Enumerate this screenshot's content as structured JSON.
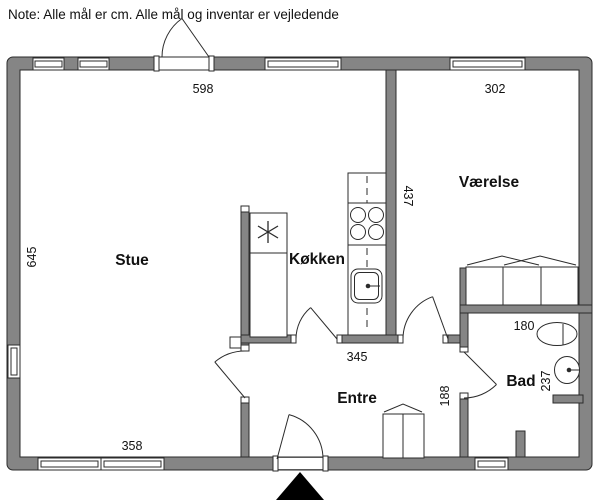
{
  "note": "Note: Alle mål er cm. Alle mål og inventar er vejledende",
  "rooms": {
    "stue": "Stue",
    "kokken": "Køkken",
    "vaerelse": "Værelse",
    "entre": "Entre",
    "bad": "Bad"
  },
  "dimensions": {
    "stue_top_width": "598",
    "vaerelse_top_width": "302",
    "left_height": "645",
    "vaerelse_height": "437",
    "kitchen_bottom": "345",
    "stue_bottom_window": "358",
    "bad_width": "180",
    "bad_height": "237",
    "entre_to_bad": "188"
  },
  "fixtures": {
    "freezer": "snowflake-icon",
    "stove": "four-burner-stove-icon",
    "sink": "kitchen-sink-icon",
    "toilet": "toilet-icon",
    "washbasin": "washbasin-icon",
    "wardrobe": "wardrobe-icon",
    "entrance": "entrance-arrow-icon"
  },
  "colors": {
    "wall": "#858585",
    "line": "#2b2b2b",
    "background": "#ffffff",
    "marker": "#000000"
  }
}
